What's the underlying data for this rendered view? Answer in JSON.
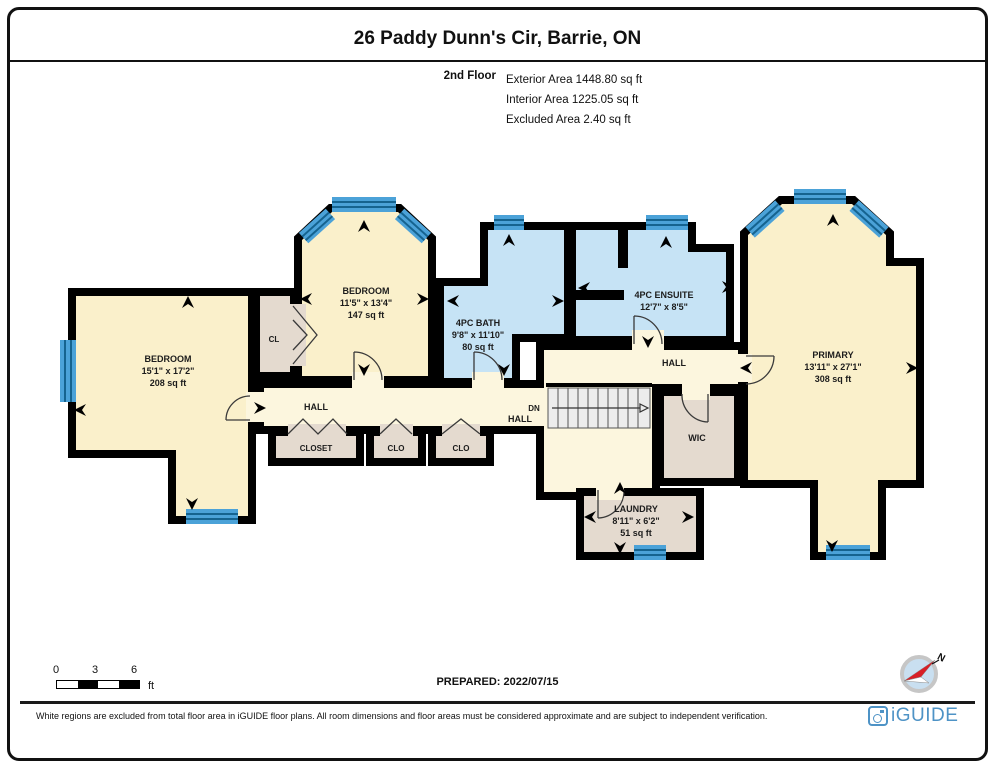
{
  "header": {
    "title": "26 Paddy Dunn's Cir, Barrie, ON",
    "floor": "2nd Floor",
    "areas": {
      "exterior": "Exterior Area 1448.80 sq ft",
      "interior": "Interior Area 1225.05 sq ft",
      "excluded": "Excluded Area 2.40 sq ft"
    }
  },
  "rooms": {
    "bedroom_left": {
      "name": "BEDROOM",
      "dims": "15'1\" x 17'2\"",
      "area": "208 sq ft"
    },
    "bedroom_mid": {
      "name": "BEDROOM",
      "dims": "11'5\" x 13'4\"",
      "area": "147 sq ft"
    },
    "cl": {
      "name": "CL"
    },
    "bath": {
      "name": "4PC BATH",
      "dims": "9'8\" x 11'10\"",
      "area": "80 sq ft"
    },
    "ensuite": {
      "name": "4PC ENSUITE",
      "dims": "12'7\" x 8'5\""
    },
    "hall_left": {
      "name": "HALL"
    },
    "hall_center": {
      "name": "HALL"
    },
    "hall_right": {
      "name": "HALL"
    },
    "closet": {
      "name": "CLOSET"
    },
    "clo1": {
      "name": "CLO"
    },
    "clo2": {
      "name": "CLO"
    },
    "stairs": {
      "name": "DN"
    },
    "wic": {
      "name": "WIC"
    },
    "laundry": {
      "name": "LAUNDRY",
      "dims": "8'11\" x 6'2\"",
      "area": "51 sq ft"
    },
    "primary": {
      "name": "PRIMARY",
      "dims": "13'11\" x 27'1\"",
      "area": "308 sq ft"
    }
  },
  "scale": {
    "t0": "0",
    "t3": "3",
    "t6": "6",
    "unit": "ft"
  },
  "prepared": "PREPARED: 2022/07/15",
  "compass": {
    "label": "N"
  },
  "footer": {
    "disclaimer": "White regions are excluded from total floor area in iGUIDE floor plans. All room dimensions and floor areas must be considered approximate and are subject to independent verification.",
    "brand": "iGUIDE"
  },
  "colors": {
    "room_cream": "#FAF0CB",
    "hall_cream": "#FCF6DE",
    "bath_blue": "#C6E3F5",
    "closet_tan": "#E4DACF",
    "window_blue": "#4BA2D8",
    "wall": "#000000",
    "brand_blue": "#4E93C6"
  }
}
